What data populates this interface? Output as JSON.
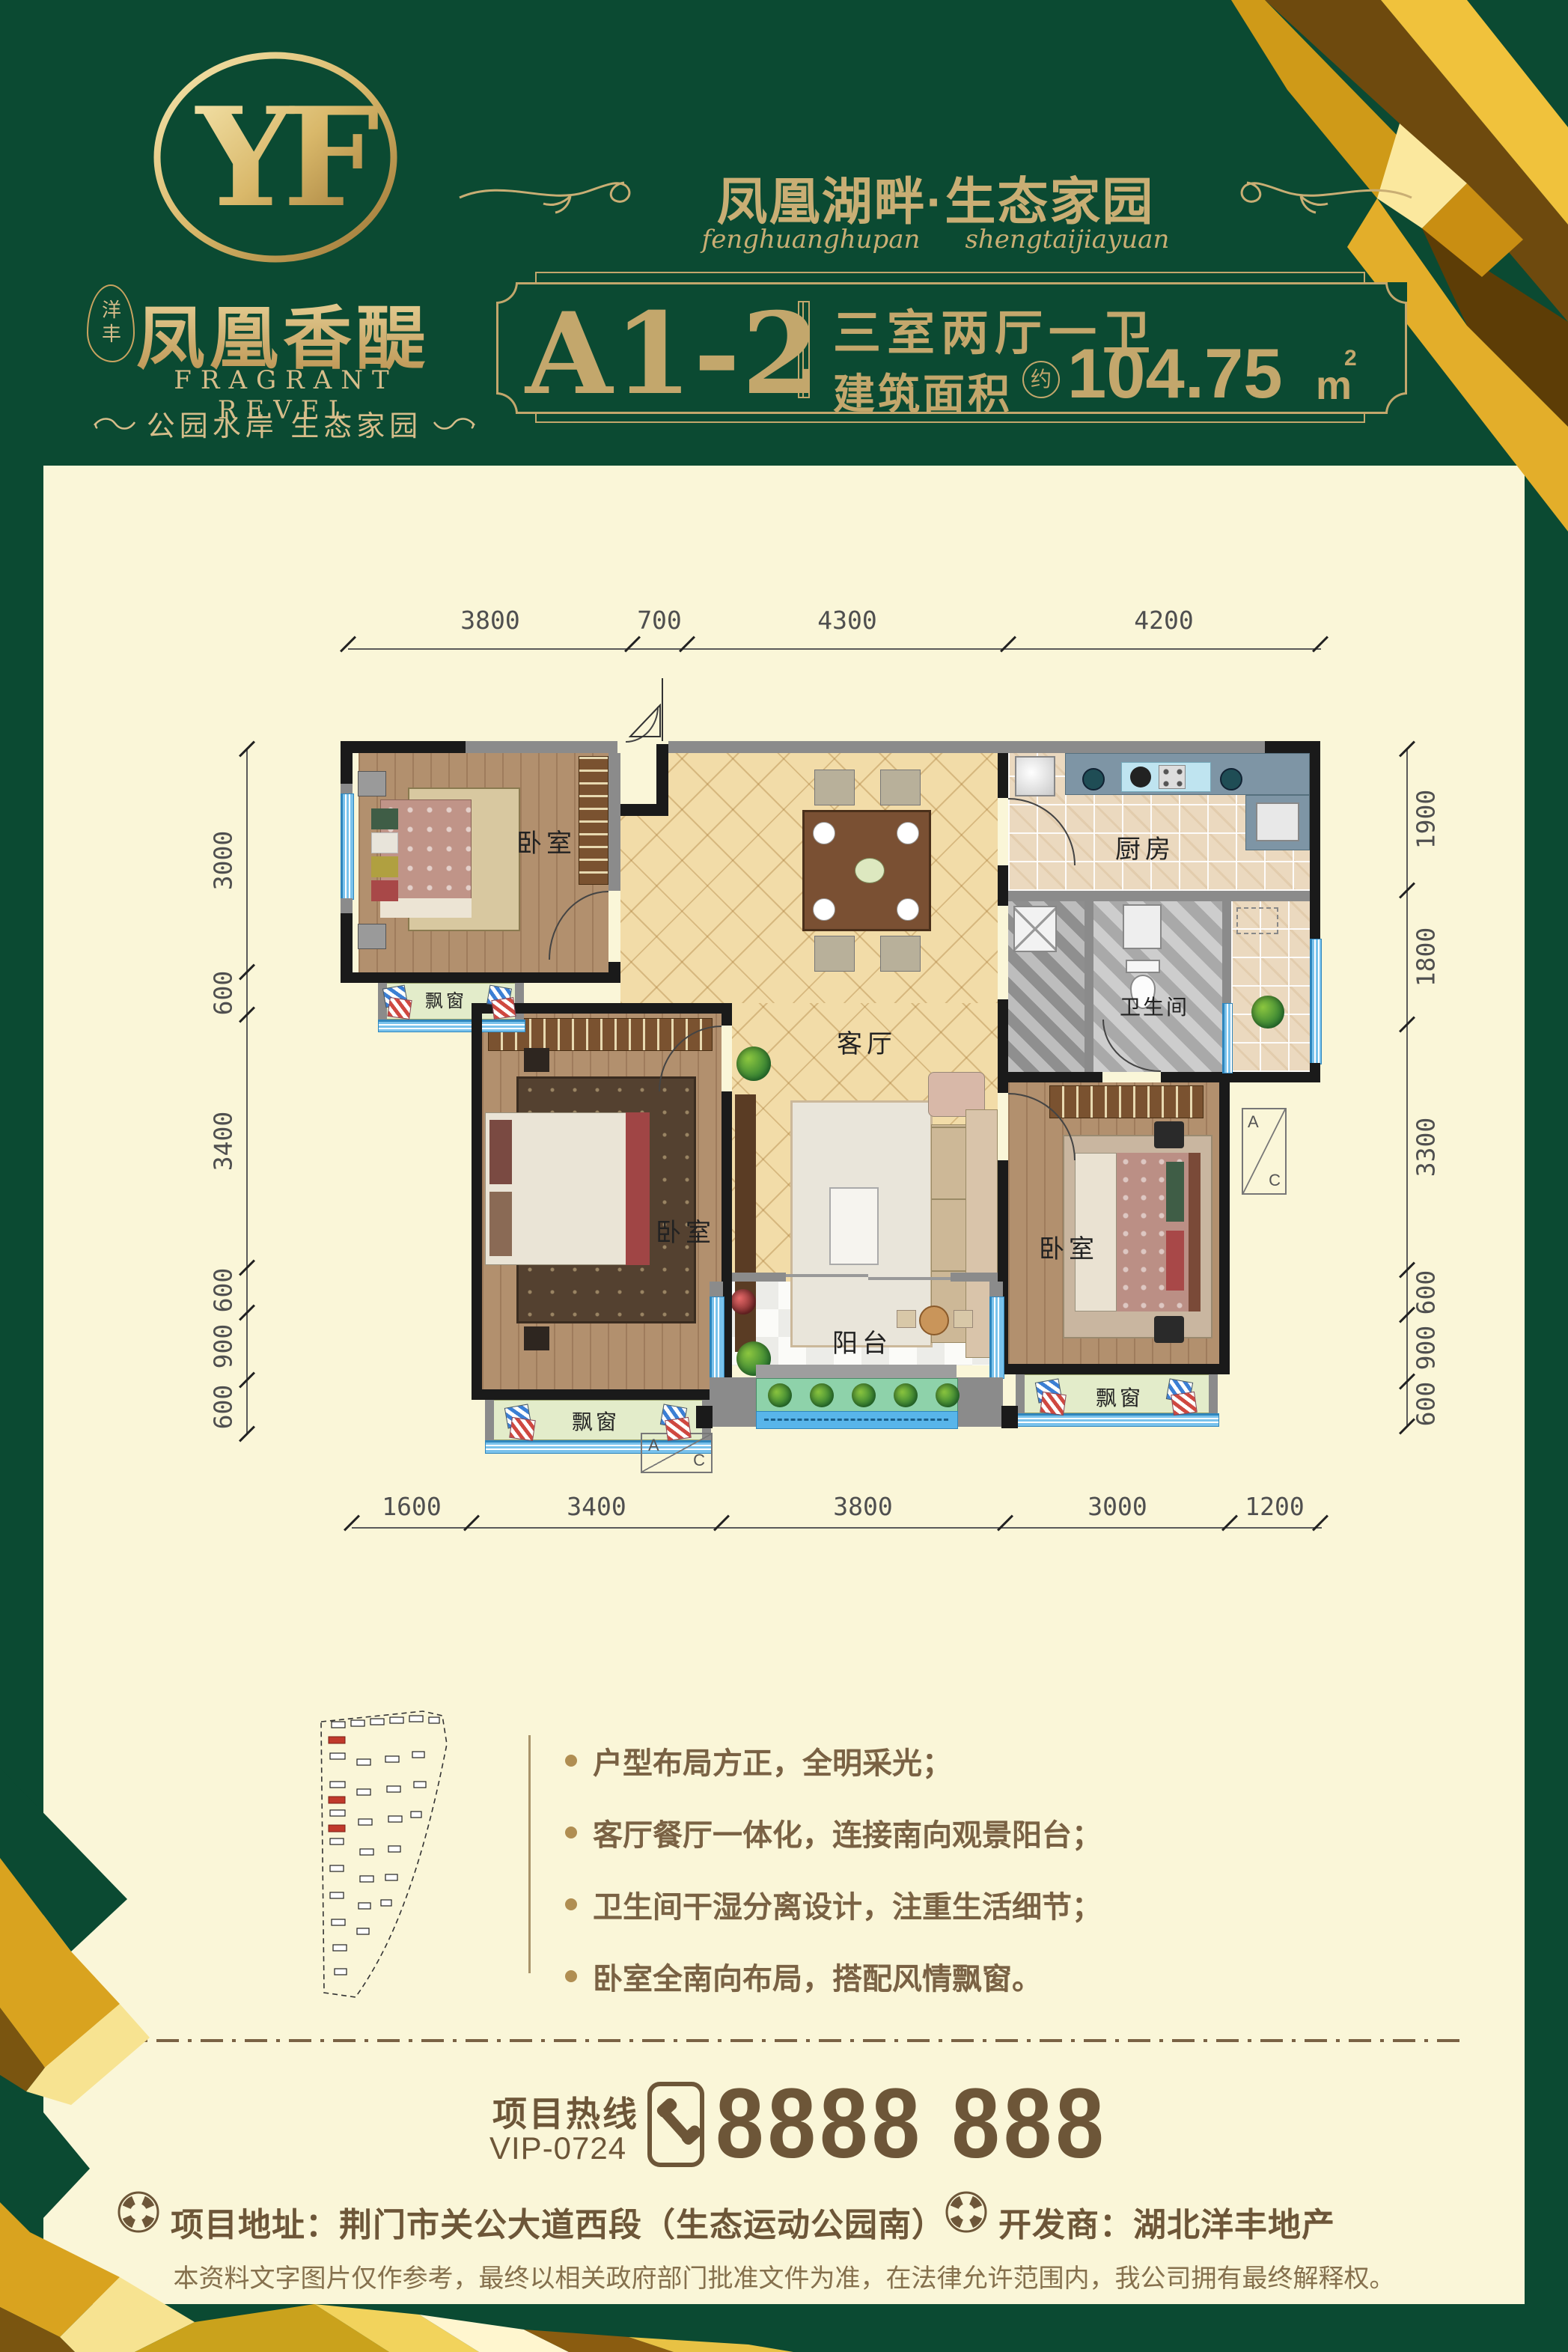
{
  "colors": {
    "green": "#0B4A32",
    "cream": "#FAF6D8",
    "gold": "#C3A76C",
    "gold_light": "#D6BD8A",
    "brown": "#6D5638",
    "text_brown": "#7A6244",
    "wall_black": "#1A1A1A",
    "window_blue": "#58AEE4",
    "bay_green": "#E3ECCA",
    "planter_green": "#8ED2AA"
  },
  "brand": {
    "monogram": "YF",
    "seal": "洋丰",
    "name_cn": "凤凰香醍",
    "name_en": "FRAGRANT REVEL",
    "slogan": "公园水岸 生态家园"
  },
  "header": {
    "title": "凤凰湖畔·生态家园",
    "pinyin1": "fenghuanghupan",
    "pinyin2": "shengtaijiayuan",
    "unit": "A1-2",
    "rooms": "三室两厅一卫",
    "area_label": "建筑面积",
    "approx": "约",
    "area": "104.75",
    "area_unit": "m",
    "area_exp": "2"
  },
  "plan": {
    "dims_top": [
      "3800",
      "700",
      "4300",
      "4200"
    ],
    "dims_left": [
      "3000",
      "600",
      "3400",
      "600",
      "900",
      "600"
    ],
    "dims_right": [
      "1900",
      "1800",
      "3300",
      "600",
      "900",
      "600"
    ],
    "dims_bottom": [
      "1600",
      "3400",
      "3800",
      "3000",
      "1200"
    ],
    "labels": {
      "bedroom": "卧室",
      "living": "客厅",
      "kitchen": "厨房",
      "bath": "卫生间",
      "balcony": "阳台",
      "bay": "飘窗",
      "ac_a": "A",
      "ac_c": "C"
    }
  },
  "features": {
    "items": [
      "户型布局方正，全明采光；",
      "客厅餐厅一体化，连接南向观景阳台；",
      "卫生间干湿分离设计，注重生活细节；",
      "卧室全南向布局，搭配风情飘窗。"
    ]
  },
  "contact": {
    "hotline_label": "项目热线",
    "hotline_vip": "VIP-0724",
    "hotline_number": "8888 888",
    "address": "项目地址：荆门市关公大道西段（生态运动公园南）",
    "developer": "开发商：湖北洋丰地产",
    "disclaimer": "本资料文字图片仅作参考，最终以相关政府部门批准文件为准，在法律允许范围内，我公司拥有最终解释权。"
  }
}
